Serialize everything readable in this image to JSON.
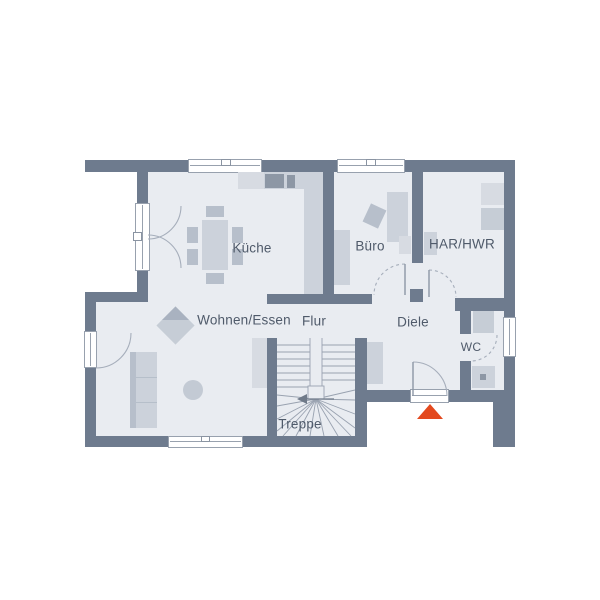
{
  "floorplan": {
    "labels": {
      "kueche": "Küche",
      "buero": "Büro",
      "har_hwr": "HAR/HWR",
      "wohnen_essen": "Wohnen/Essen",
      "flur": "Flur",
      "diele": "Diele",
      "wc": "WC",
      "treppe": "Treppe"
    },
    "colors": {
      "wall": "#6e7b8e",
      "floor": "#e9ecf1",
      "furniture": "#ccd2db",
      "appliance": "#8d97a5",
      "entrance_marker": "#e3491e",
      "label_text": "#4f5a6a"
    }
  }
}
